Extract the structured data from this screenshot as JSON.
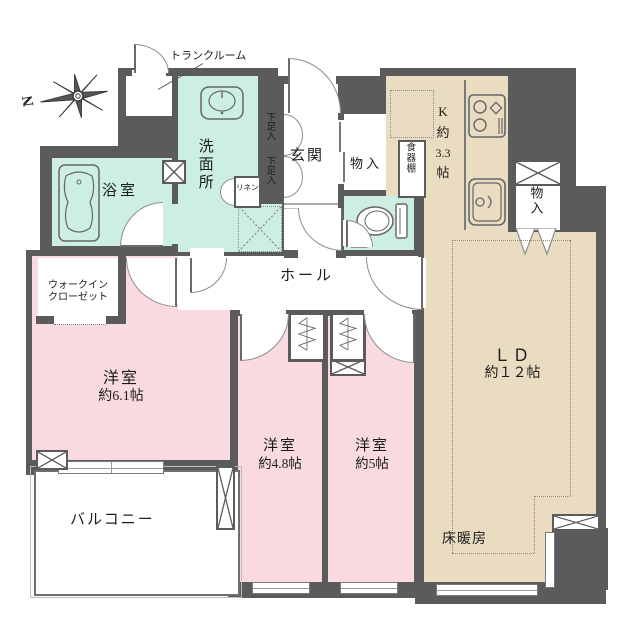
{
  "plan": {
    "title": "apartment-floor-plan",
    "compass": {
      "north_label": "N"
    },
    "rooms": {
      "trunk": {
        "label": "トランクルーム"
      },
      "washroom": {
        "label": "洗面所"
      },
      "bathroom": {
        "label": "浴室"
      },
      "wic": {
        "line1": "ウォークイン",
        "line2": "クローゼット"
      },
      "entrance": {
        "label": "玄関"
      },
      "shoe1": {
        "label": "下足入"
      },
      "shoe2": {
        "label": "下足入"
      },
      "linen": {
        "label": "リネン"
      },
      "storage1": {
        "label": "物入"
      },
      "storage2": {
        "label": "物入"
      },
      "cupboard": {
        "label": "食器棚"
      },
      "kitchen": {
        "l1": "K",
        "l2": "約",
        "l3": "3.3",
        "l4": "帖"
      },
      "hall": {
        "label": "ホール"
      },
      "ld": {
        "line1": "ＬＤ",
        "line2": "約１２帖"
      },
      "bed61": {
        "line1": "洋室",
        "line2": "約6.1帖"
      },
      "bed48": {
        "line1": "洋室",
        "line2": "約4.8帖"
      },
      "bed5": {
        "line1": "洋室",
        "line2": "約5帖"
      },
      "balcony": {
        "label": "バルコニー"
      },
      "floor_heating": {
        "label": "床暖房"
      }
    },
    "icons": {
      "compass": "compass-star",
      "bathtub": "bathtub",
      "washstand": "wash-basin",
      "toilet": "toilet",
      "stove": "gas-stove",
      "kitchen_sink": "kitchen-sink",
      "closet_pipe": "hanger-pipe-zigzag",
      "pipe_shaft": "x-cross-box",
      "washer_space": "dotted-x-box"
    },
    "colors": {
      "wall": "#5b5b5b",
      "water_rooms": "#cdeee2",
      "kitchen_ld": "#e9dcc1",
      "bedrooms": "#f9dae1",
      "background": "#ffffff"
    }
  }
}
